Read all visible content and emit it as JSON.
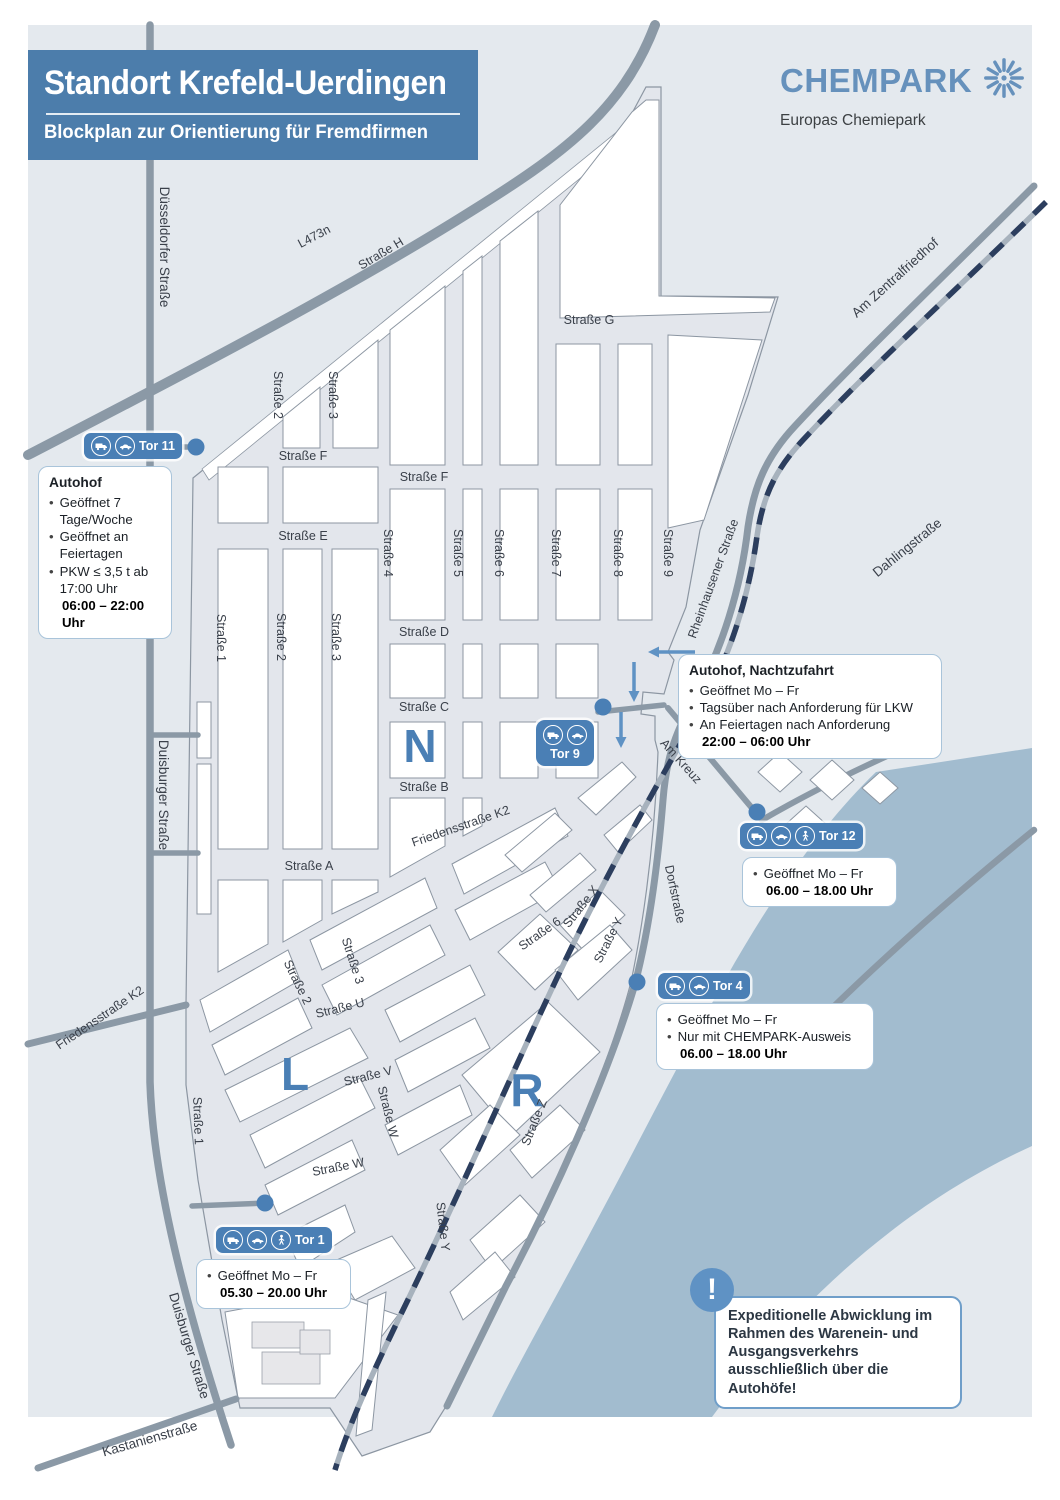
{
  "header": {
    "title": "Standort Krefeld-Uerdingen",
    "subtitle": "Blockplan zur Orientierung für Fremdfirmen"
  },
  "logo": {
    "name": "CHEMPARK",
    "tagline": "Europas Chemiepark"
  },
  "zones": {
    "n": "N",
    "l": "L",
    "r": "R"
  },
  "streets": {
    "duesseldorfer": "Düsseldorfer Straße",
    "l473n": "L473n",
    "strasse_h": "Straße H",
    "am_zentralfriedhof": "Am Zentralfriedhof",
    "dahlingstrasse": "Dahlingstraße",
    "rheinhausener": "Rheinhausener Straße",
    "strasse_g": "Straße G",
    "strasse_f": "Straße F",
    "strasse_e": "Straße E",
    "strasse_d": "Straße D",
    "strasse_c": "Straße C",
    "strasse_b": "Straße B",
    "strasse_a": "Straße A",
    "s1": "Straße 1",
    "s2": "Straße 2",
    "s3": "Straße 3",
    "s4": "Straße 4",
    "s5": "Straße 5",
    "s6": "Straße 6",
    "s7": "Straße 7",
    "s8": "Straße 8",
    "s9": "Straße 9",
    "duisburger": "Duisburger Straße",
    "friedensstrasse": "Friedensstraße K2",
    "am_kreuz": "Am Kreuz",
    "dorfstrasse": "Dorfstraße",
    "strasse_x": "Straße X",
    "strasse_y": "Straße Y",
    "strasse_z": "Straße Z",
    "strasse_u": "Straße U",
    "strasse_v": "Straße V",
    "strasse_w": "Straße W",
    "kastanienstrasse": "Kastanienstraße"
  },
  "gates": {
    "tor11": {
      "label": "Tor 11",
      "icons": [
        "truck",
        "car"
      ],
      "info_title": "Autohof",
      "lines": [
        "Geöffnet 7 Tage/Woche",
        "Geöffnet an Feiertagen",
        "PKW ≤ 3,5 t ab 17:00 Uhr"
      ],
      "hours": "06:00 – 22:00 Uhr"
    },
    "tor9": {
      "label": "Tor 9",
      "icons": [
        "truck",
        "car"
      ],
      "info_title": "Autohof, Nachtzufahrt",
      "lines": [
        "Geöffnet Mo – Fr",
        "Tagsüber nach Anforderung für LKW",
        "An Feiertagen nach Anforderung"
      ],
      "hours": "22:00 – 06:00 Uhr"
    },
    "tor12": {
      "label": "Tor 12",
      "icons": [
        "truck",
        "car",
        "pedestrian"
      ],
      "lines": [
        "Geöffnet Mo – Fr"
      ],
      "hours": "06.00 – 18.00 Uhr"
    },
    "tor4": {
      "label": "Tor 4",
      "icons": [
        "truck",
        "car"
      ],
      "lines": [
        "Geöffnet Mo – Fr",
        "Nur mit CHEMPARK-Ausweis"
      ],
      "hours": "06.00 – 18.00 Uhr"
    },
    "tor1": {
      "label": "Tor 1",
      "icons": [
        "truck",
        "car",
        "pedestrian"
      ],
      "lines": [
        "Geöffnet Mo – Fr"
      ],
      "hours": "05.30 – 20.00 Uhr"
    }
  },
  "notice": {
    "text": "Expeditionelle Abwicklung im Rahmen des Warenein- und Ausgangsverkehrs ausschließlich über die Autohöfe!"
  },
  "colors": {
    "accent_blue": "#4a7fb5",
    "title_bg": "#4c7dab",
    "logo_blue": "#6691bc",
    "map_bg": "#e4e9ee",
    "site_street": "#e3e6ec",
    "block_white": "#ffffff",
    "road_gray": "#8b99a6",
    "railway_navy": "#2c3e5e",
    "river_blue": "#a2bccf"
  }
}
